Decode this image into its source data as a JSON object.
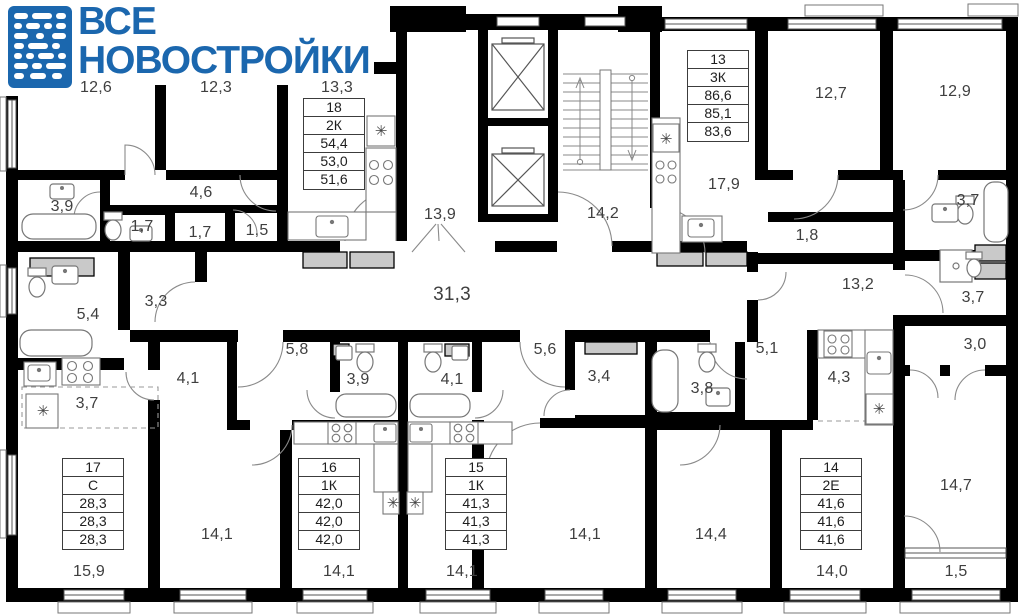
{
  "logo": {
    "line1": "ВСЕ",
    "line2": "НОВОСТРОЙКИ"
  },
  "colors": {
    "brand": "#1b67ae",
    "wall": "#000000",
    "label": "#3f3f3f",
    "wardrobe": "#c9c9c9"
  },
  "floor_plan": {
    "washer_symbol": "✳",
    "room_labels": [
      {
        "text": "12,6",
        "x": 96,
        "y": 88
      },
      {
        "text": "12,3",
        "x": 216,
        "y": 88
      },
      {
        "text": "13,3",
        "x": 337,
        "y": 88
      },
      {
        "text": "12,7",
        "x": 831,
        "y": 94
      },
      {
        "text": "12,9",
        "x": 955,
        "y": 92
      },
      {
        "text": "3,9",
        "x": 62,
        "y": 207
      },
      {
        "text": "4,6",
        "x": 201,
        "y": 193
      },
      {
        "text": "1,7",
        "x": 142,
        "y": 227
      },
      {
        "text": "1,7",
        "x": 200,
        "y": 233
      },
      {
        "text": "1,5",
        "x": 257,
        "y": 231
      },
      {
        "text": "13,9",
        "x": 440,
        "y": 215
      },
      {
        "text": "14,2",
        "x": 603,
        "y": 214
      },
      {
        "text": "17,9",
        "x": 724,
        "y": 185
      },
      {
        "text": "1,8",
        "x": 807,
        "y": 236
      },
      {
        "text": "3,7",
        "x": 968,
        "y": 201
      },
      {
        "text": "3,7",
        "x": 973,
        "y": 298
      },
      {
        "text": "3,0",
        "x": 975,
        "y": 345
      },
      {
        "text": "13,2",
        "x": 858,
        "y": 285
      },
      {
        "text": "5,4",
        "x": 88,
        "y": 315
      },
      {
        "text": "3,3",
        "x": 156,
        "y": 302
      },
      {
        "text": "31,3",
        "x": 452,
        "y": 295,
        "big": true
      },
      {
        "text": "5,8",
        "x": 297,
        "y": 350
      },
      {
        "text": "3,9",
        "x": 358,
        "y": 380
      },
      {
        "text": "4,1",
        "x": 188,
        "y": 379
      },
      {
        "text": "4,1",
        "x": 452,
        "y": 380
      },
      {
        "text": "5,6",
        "x": 545,
        "y": 350
      },
      {
        "text": "3,4",
        "x": 599,
        "y": 377
      },
      {
        "text": "3,8",
        "x": 702,
        "y": 389
      },
      {
        "text": "5,1",
        "x": 767,
        "y": 349
      },
      {
        "text": "4,3",
        "x": 839,
        "y": 378
      },
      {
        "text": "3,7",
        "x": 87,
        "y": 404
      },
      {
        "text": "14,7",
        "x": 956,
        "y": 486
      },
      {
        "text": "15,9",
        "x": 89,
        "y": 572
      },
      {
        "text": "14,1",
        "x": 217,
        "y": 535
      },
      {
        "text": "14,1",
        "x": 339,
        "y": 572
      },
      {
        "text": "14,1",
        "x": 462,
        "y": 572
      },
      {
        "text": "14,1",
        "x": 585,
        "y": 535
      },
      {
        "text": "14,4",
        "x": 711,
        "y": 535
      },
      {
        "text": "14,0",
        "x": 832,
        "y": 572
      },
      {
        "text": "1,5",
        "x": 956,
        "y": 572
      }
    ],
    "washer_marks": [
      {
        "x": 381,
        "y": 131
      },
      {
        "x": 666,
        "y": 139
      },
      {
        "x": 43,
        "y": 411
      },
      {
        "x": 393,
        "y": 503
      },
      {
        "x": 415,
        "y": 503
      },
      {
        "x": 879,
        "y": 409
      }
    ],
    "apartments": [
      {
        "number": "18",
        "type": "2К",
        "areas": [
          "54,4",
          "53,0",
          "51,6"
        ],
        "x": 303,
        "y": 98
      },
      {
        "number": "13",
        "type": "3К",
        "areas": [
          "86,6",
          "85,1",
          "83,6"
        ],
        "x": 687,
        "y": 50
      },
      {
        "number": "17",
        "type": "С",
        "areas": [
          "28,3",
          "28,3",
          "28,3"
        ],
        "x": 62,
        "y": 458
      },
      {
        "number": "16",
        "type": "1К",
        "areas": [
          "42,0",
          "42,0",
          "42,0"
        ],
        "x": 298,
        "y": 458
      },
      {
        "number": "15",
        "type": "1К",
        "areas": [
          "41,3",
          "41,3",
          "41,3"
        ],
        "x": 445,
        "y": 458
      },
      {
        "number": "14",
        "type": "2Е",
        "areas": [
          "41,6",
          "41,6",
          "41,6"
        ],
        "x": 800,
        "y": 458
      }
    ]
  }
}
